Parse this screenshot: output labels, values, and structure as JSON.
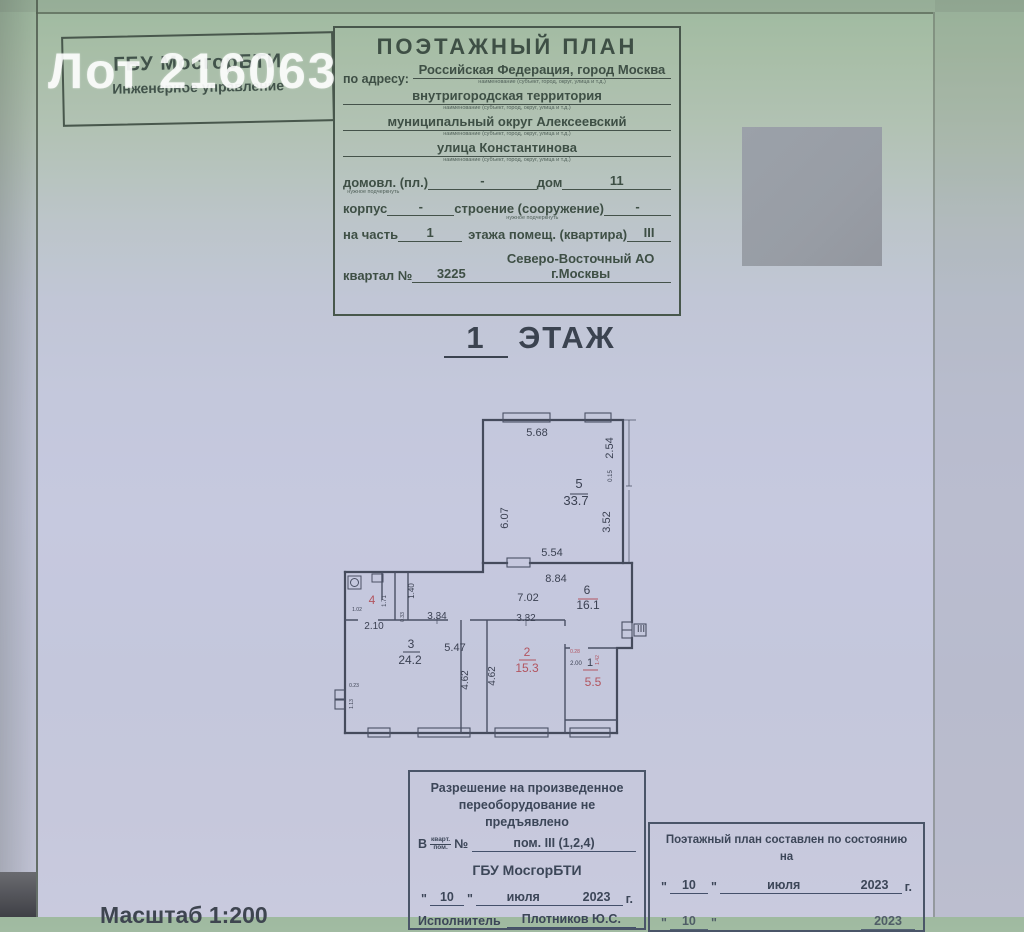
{
  "watermark": "Лот 216063",
  "org_box": {
    "line1": "ГБУ МосгорБТИ",
    "line2": "Инженерное управление"
  },
  "title_block": {
    "title": "ПОЭТАЖНЫЙ ПЛАН",
    "address_label": "по адресу:",
    "address_caption": "наименование (субъект, город, округ, улица и т.д.)",
    "address_lines": [
      {
        "value": "Российская Федерация, город Москва"
      },
      {
        "value": "внутригородская территория"
      },
      {
        "value": "муниципальный округ Алексеевский"
      },
      {
        "value": "улица Константинова"
      }
    ],
    "fields": {
      "underline_caption": "нужное подчеркнуть",
      "domovl_label": "домовл. (пл.)",
      "domovl_value": "-",
      "dom_label": "дом",
      "dom_value": "11",
      "korpus_label": "корпус",
      "korpus_value": "-",
      "stroenie_label": "строение (сооружение)",
      "stroenie_value": "-",
      "na_chast_label": "на часть",
      "na_chast_value": "1",
      "etazha_label": "этажа помещ. (квартира)",
      "etazha_value": "III",
      "kvartal_label": "квартал №",
      "kvartal_value": "3225",
      "okrug_value": "Северо-Восточный АО г.Москвы"
    }
  },
  "floor_heading": {
    "number": "1",
    "label": "ЭТАЖ"
  },
  "plan": {
    "entrance_label": "III",
    "rooms": [
      {
        "number": "1",
        "area": "5.5"
      },
      {
        "number": "2",
        "area": "15.3"
      },
      {
        "number": "3",
        "area": "24.2"
      },
      {
        "number": "4",
        "area": ""
      },
      {
        "number": "5",
        "area": "33.7"
      },
      {
        "number": "6",
        "area": "16.1"
      }
    ],
    "labels": [
      {
        "t": "5.68",
        "x": 207,
        "y": 38,
        "fs": 11
      },
      {
        "t": "2.54",
        "x": 283,
        "y": 50,
        "r": -90,
        "fs": 11
      },
      {
        "t": "0.15",
        "x": 282,
        "y": 78,
        "r": -90,
        "fs": 6
      },
      {
        "t": "3.52",
        "x": 280,
        "y": 124,
        "r": -90,
        "fs": 11
      },
      {
        "t": "6.07",
        "x": 178,
        "y": 120,
        "r": -90,
        "fs": 11
      },
      {
        "t": "5",
        "x": 249,
        "y": 90,
        "fs": 13
      },
      {
        "t": "33.7",
        "x": 246,
        "y": 107,
        "fs": 13
      },
      {
        "t": "5.54",
        "x": 222,
        "y": 158,
        "fs": 11
      },
      {
        "t": "8.84",
        "x": 226,
        "y": 184,
        "fs": 11
      },
      {
        "t": "7.02",
        "x": 198,
        "y": 203,
        "fs": 11
      },
      {
        "t": "6",
        "x": 257,
        "y": 196,
        "fs": 12
      },
      {
        "t": "16.1",
        "x": 258,
        "y": 211,
        "fs": 12
      },
      {
        "t": "1.40",
        "x": 84,
        "y": 193,
        "r": -90,
        "fs": 8
      },
      {
        "t": "4",
        "x": 42,
        "y": 206,
        "fs": 12,
        "c": "red"
      },
      {
        "t": "1.02",
        "x": 27,
        "y": 213,
        "fs": 5
      },
      {
        "t": "1.71",
        "x": 56,
        "y": 203,
        "r": -90,
        "fs": 6
      },
      {
        "t": "0.33",
        "x": 74,
        "y": 219,
        "r": -90,
        "fs": 5
      },
      {
        "t": "2.10",
        "x": 44,
        "y": 231,
        "fs": 10
      },
      {
        "t": "3.34",
        "x": 107,
        "y": 221,
        "fs": 10
      },
      {
        "t": "3.32",
        "x": 196,
        "y": 223,
        "fs": 10
      },
      {
        "t": "3",
        "x": 81,
        "y": 250,
        "fs": 12
      },
      {
        "t": "24.2",
        "x": 80,
        "y": 266,
        "fs": 12
      },
      {
        "t": "5.47",
        "x": 125,
        "y": 253,
        "fs": 11
      },
      {
        "t": "4.62",
        "x": 138,
        "y": 282,
        "r": -90,
        "fs": 10
      },
      {
        "t": "4.62",
        "x": 165,
        "y": 278,
        "r": -90,
        "fs": 10
      },
      {
        "t": "0.23",
        "x": 24,
        "y": 289,
        "fs": 5
      },
      {
        "t": "1.13",
        "x": 23,
        "y": 306,
        "r": -90,
        "fs": 5
      },
      {
        "t": "2",
        "x": 197,
        "y": 258,
        "fs": 12,
        "c": "red"
      },
      {
        "t": "15.3",
        "x": 197,
        "y": 274,
        "fs": 12,
        "c": "red"
      },
      {
        "t": "0.28",
        "x": 245,
        "y": 255,
        "fs": 5,
        "c": "red"
      },
      {
        "t": "2.00",
        "x": 246,
        "y": 267,
        "fs": 6
      },
      {
        "t": "1",
        "x": 260,
        "y": 268,
        "fs": 11
      },
      {
        "t": "1.42",
        "x": 269,
        "y": 262,
        "r": -90,
        "fs": 5,
        "c": "red"
      },
      {
        "t": "5.5",
        "x": 263,
        "y": 288,
        "fs": 12,
        "c": "red"
      },
      {
        "t": "III",
        "x": 311,
        "y": 234,
        "fs": 10
      }
    ],
    "bars": [
      {
        "x1": 240,
        "x2": 258,
        "y": 96
      },
      {
        "x1": 248,
        "x2": 268,
        "y": 201,
        "c": "red"
      },
      {
        "x1": 73,
        "x2": 90,
        "y": 254
      },
      {
        "x1": 189,
        "x2": 206,
        "y": 262,
        "c": "red"
      },
      {
        "x1": 253,
        "x2": 268,
        "y": 272,
        "c": "red"
      }
    ]
  },
  "stamps": {
    "quote_char": "\"",
    "left": {
      "line1": "Разрешение на произведенное",
      "line2": "переоборудование не предъявлено",
      "prefix": "В",
      "fraction_top": "кварт.",
      "fraction_bottom": "пом.",
      "num_label": "№",
      "value": "пом. III (1,2,4)",
      "org": "ГБУ МосгорБТИ",
      "day": "10",
      "month": "июля",
      "year": "2023",
      "year_suffix": "г.",
      "executor_label": "Исполнитель",
      "executor_value": "Плотников Ю.С."
    },
    "right": {
      "title": "Поэтажный план составлен по состоянию на",
      "day": "10",
      "month": "июля",
      "year": "2023",
      "year_suffix": "г.",
      "day2": "10",
      "year2": "2023"
    }
  },
  "scale_label": "Масштаб 1:200"
}
